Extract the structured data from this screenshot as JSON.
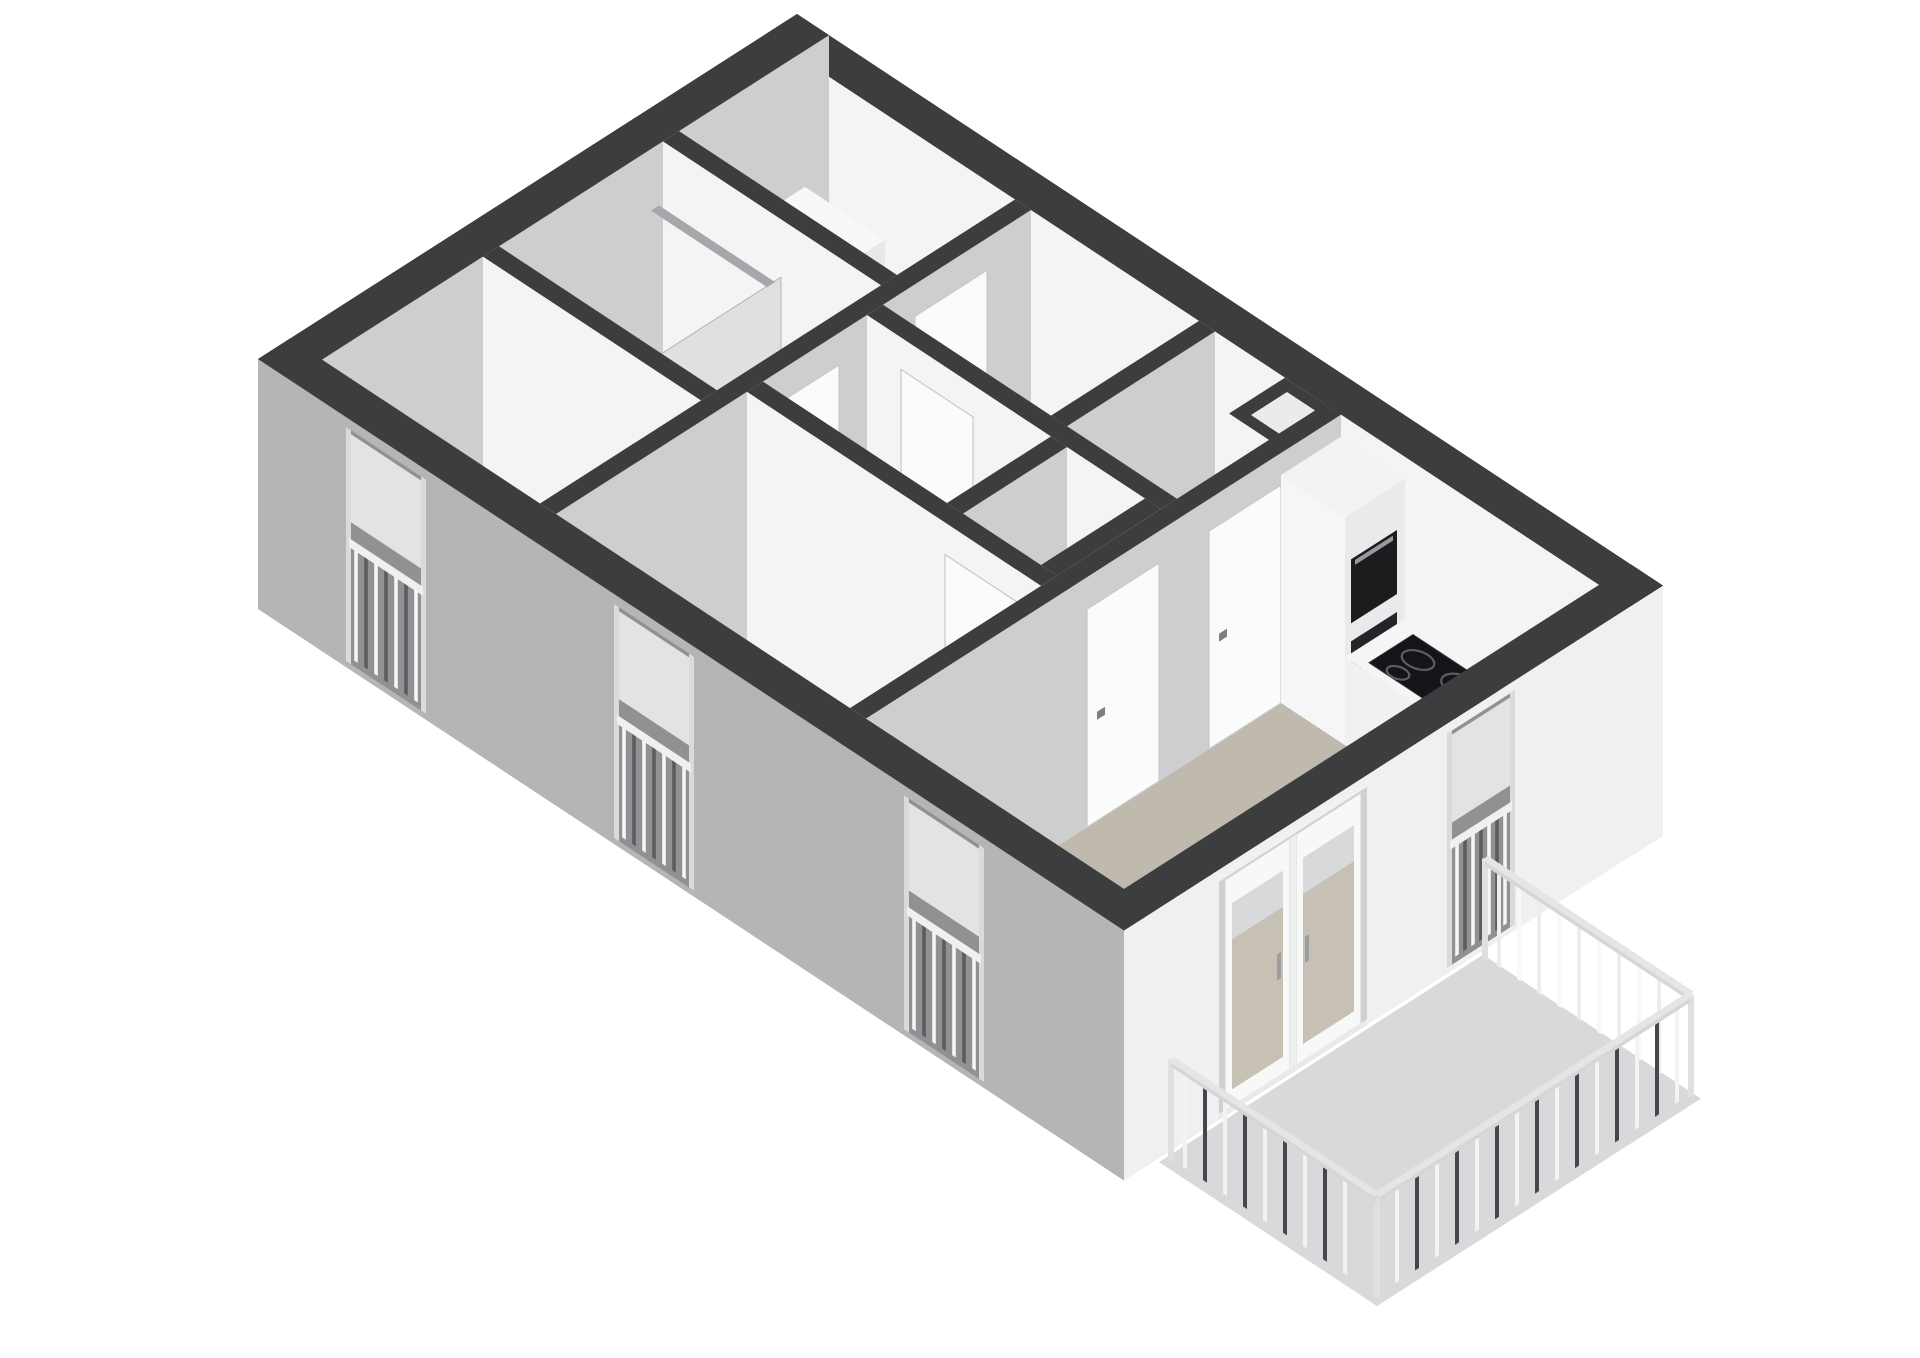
{
  "meta": {
    "view_label": "3d-floorplan-render"
  },
  "colors": {
    "bg": "#ffffff",
    "cap": "#3b3d3f",
    "faceU": "#cccecf",
    "faceV": "#f3f4f4",
    "facadeGray": "#b3b5b7",
    "facadeWhite": "#eef0f1",
    "floorLight": "#d0d2d3",
    "floorMid": "#bcbec0",
    "floorDark": "#a9abad",
    "floorBeige": "#c0b9ad",
    "floorBalcony": "#d8d9da",
    "doorLeaf": "#fafbfb",
    "doorEdge": "#c7c9cb",
    "handle": "#7d7f82",
    "glassBeige": "#c7c0b4",
    "glassGray": "#e2e3e4",
    "glassPane": "#ccd0d2",
    "recessDark": "#8f9193",
    "recessLight": "#cfd0d1",
    "chrome": "#a5a7aa",
    "cooktopBlack": "#141518",
    "burnerRing": "#5c5e61",
    "railLightA": "#eceded",
    "railLightB": "#f7f8f8",
    "railDarkA": "#f2f3f3",
    "railDarkB": "#45474a",
    "railTop": "#d5d6d7",
    "post": "#dfe0e1"
  },
  "scene": {
    "canvas": {
      "w": 1920,
      "h": 1358
    },
    "projection": {
      "originX": 797,
      "originY": 264,
      "uy": 0.66,
      "vy": 0.64,
      "wallHeight": 250
    },
    "items": [
      {
        "t": "floor",
        "n": "closet-floor",
        "r": [
          32,
          32,
          250,
          150
        ],
        "c": "floorLight"
      },
      {
        "t": "floor",
        "n": "bathroom-floor",
        "r": [
          32,
          166,
          250,
          330
        ],
        "c": "floorLight"
      },
      {
        "t": "floor",
        "n": "bedroom1-floor",
        "r": [
          32,
          346,
          250,
          507
        ],
        "c": "floorMid"
      },
      {
        "t": "floor",
        "n": "storage-floor",
        "r": [
          266,
          32,
          434,
          180
        ],
        "c": "floorLight"
      },
      {
        "t": "floor",
        "n": "hall-nook-floor",
        "r": [
          450,
          32,
          520,
          196
        ],
        "c": "floorLight"
      },
      {
        "t": "floor",
        "n": "hall-floor",
        "r": [
          266,
          196,
          560,
          300
        ],
        "c": "floorLight"
      },
      {
        "t": "floor",
        "n": "wc-floor",
        "r": [
          466,
          196,
          544,
          300
        ],
        "c": "floorMid"
      },
      {
        "t": "floor",
        "n": "bedroom2-floor",
        "r": [
          266,
          316,
          560,
          507
        ],
        "c": "floorDark"
      },
      {
        "t": "floor",
        "n": "living-room-floor",
        "r": [
          576,
          32,
          834,
          507
        ],
        "c": "floorBeige"
      },
      {
        "t": "wall",
        "n": "wall-ne",
        "r": [
          0,
          0,
          866,
          32
        ]
      },
      {
        "t": "wall",
        "n": "wall-nw",
        "r": [
          0,
          0,
          32,
          539
        ]
      },
      {
        "t": "box",
        "n": "boiler",
        "r": [
          60,
          52,
          140,
          118
        ],
        "h": 150,
        "cap": "#f7f8f8",
        "fu": "#e7e8e9",
        "fv": "#f4f5f5"
      },
      {
        "t": "dots",
        "n": "boiler-vents",
        "pts": [
          [
            88,
            86
          ],
          [
            114,
            86
          ]
        ],
        "h": 150,
        "rad": 4.5,
        "c": "#55575a"
      },
      {
        "t": "wall",
        "n": "wall-closet-bath",
        "r": [
          32,
          150,
          250,
          166
        ]
      },
      {
        "t": "glassU",
        "n": "shower-screen",
        "u": 160,
        "v1": 176,
        "v2": 300,
        "h1": 0,
        "h2": 205
      },
      {
        "t": "top",
        "n": "shower-rail",
        "h": 204,
        "r": [
          44,
          182,
          160,
          190
        ],
        "c": "chrome"
      },
      {
        "t": "wall",
        "n": "wall-bath-bedroom1",
        "r": [
          32,
          330,
          250,
          346
        ]
      },
      {
        "t": "wall",
        "n": "wall-spine-west",
        "r": [
          250,
          32,
          266,
          507
        ]
      },
      {
        "t": "door",
        "n": "hall-door-north",
        "p": "U",
        "at": 266,
        "a1": 76,
        "a2": 148
      },
      {
        "t": "door",
        "n": "bathroom-door",
        "p": "U",
        "at": 266,
        "a1": 224,
        "a2": 296
      },
      {
        "t": "wall",
        "n": "wall-storage-east",
        "r": [
          434,
          32,
          450,
          180
        ]
      },
      {
        "t": "wall",
        "n": "wall-hall-north",
        "r": [
          266,
          180,
          560,
          196
        ]
      },
      {
        "t": "door",
        "n": "storage-door",
        "p": "V",
        "at": 196,
        "a1": 300,
        "a2": 372
      },
      {
        "t": "box",
        "n": "duct-shaft",
        "r": [
          520,
          32,
          576,
          88
        ],
        "h": 250
      },
      {
        "t": "top",
        "n": "duct-shaft-opening",
        "h": 250,
        "r": [
          532,
          42,
          566,
          78
        ],
        "c": "#eaebeb"
      },
      {
        "t": "wall",
        "n": "wall-wc-west",
        "r": [
          450,
          196,
          466,
          300
        ]
      },
      {
        "t": "wall",
        "n": "wall-wc-east",
        "r": [
          544,
          196,
          560,
          300
        ]
      },
      {
        "t": "wall",
        "n": "wall-bedroom2-north",
        "r": [
          266,
          300,
          560,
          316
        ]
      },
      {
        "t": "door",
        "n": "bedroom2-door",
        "p": "V",
        "at": 316,
        "a1": 464,
        "a2": 538
      },
      {
        "t": "wall",
        "n": "wall-living-west",
        "r": [
          560,
          32,
          576,
          507
        ]
      },
      {
        "t": "door",
        "n": "living-room-door",
        "p": "U",
        "at": 576,
        "a1": 92,
        "a2": 164
      },
      {
        "t": "door",
        "n": "hall-door-south",
        "p": "U",
        "at": 576,
        "a1": 214,
        "a2": 286
      },
      {
        "t": "box",
        "n": "kitchen-tall-cabinet",
        "r": [
          576,
          32,
          640,
          92
        ],
        "h": 228,
        "cap": "#f2f3f3",
        "fu": "#e9eaeb",
        "fv": "#f5f6f6"
      },
      {
        "t": "faceU",
        "n": "oven",
        "u": 640,
        "v1": 40,
        "v2": 86,
        "h1": 118,
        "h2": 182,
        "c": "#1b1c1e"
      },
      {
        "t": "faceU",
        "n": "oven-handle",
        "u": 640,
        "v1": 44,
        "v2": 82,
        "h1": 174,
        "h2": 179,
        "c": "#97999c"
      },
      {
        "t": "faceU",
        "n": "oven-drawer",
        "u": 640,
        "v1": 40,
        "v2": 86,
        "h1": 66,
        "h2": 100,
        "c": "#232528"
      },
      {
        "t": "box",
        "n": "kitchen-counter",
        "r": [
          640,
          32,
          834,
          92
        ],
        "h": 88,
        "cap": "#f4f5f5",
        "fu": "#e9eaea",
        "fv": "#f0f1f1"
      },
      {
        "t": "cooktop",
        "n": "cooktop",
        "r": [
          656,
          40,
          744,
          84
        ],
        "h": 88,
        "burners": [
          [
            678,
            57,
            13
          ],
          [
            678,
            77,
            9
          ],
          [
            718,
            55,
            15
          ],
          [
            722,
            77,
            10
          ]
        ]
      },
      {
        "t": "sink",
        "n": "kitchen-sink",
        "cx": 788,
        "cy": 62,
        "h": 88
      },
      {
        "t": "wall",
        "n": "wall-sw",
        "r": [
          0,
          507,
          866,
          539
        ],
        "fv": "facadeGray",
        "fu": "#f0f1f1"
      },
      {
        "t": "windowV",
        "n": "bedroom1-window",
        "at": 539,
        "a1": 88,
        "a2": 168
      },
      {
        "t": "windowV",
        "n": "bedroom2-window",
        "at": 539,
        "a1": 356,
        "a2": 436
      },
      {
        "t": "windowV",
        "n": "living-room-window-sw",
        "at": 539,
        "a1": 646,
        "a2": 726
      },
      {
        "t": "wall",
        "n": "wall-se",
        "r": [
          834,
          0,
          866,
          539
        ],
        "fu": "facadeWhite",
        "fv": "facadeGray"
      },
      {
        "t": "windowU",
        "n": "living-room-window-se",
        "at": 866,
        "a1": 148,
        "a2": 216
      },
      {
        "t": "balconyDoor",
        "n": "balcony-doors",
        "at": 866,
        "a1": 296,
        "a2": 444
      },
      {
        "t": "floor",
        "n": "balcony-floor",
        "r": [
          866,
          180,
          1084,
          504
        ],
        "c": "floorBalcony",
        "h": -4
      },
      {
        "t": "railV",
        "n": "balcony-railing-ne",
        "v": 186,
        "a1": 874,
        "a2": 1080,
        "tone": "light"
      },
      {
        "t": "railU",
        "n": "balcony-railing-se",
        "u": 1080,
        "a1": 186,
        "a2": 500,
        "tone": "dark"
      },
      {
        "t": "railV",
        "n": "balcony-railing-sw",
        "v": 500,
        "a1": 874,
        "a2": 1080,
        "tone": "dark"
      }
    ]
  }
}
